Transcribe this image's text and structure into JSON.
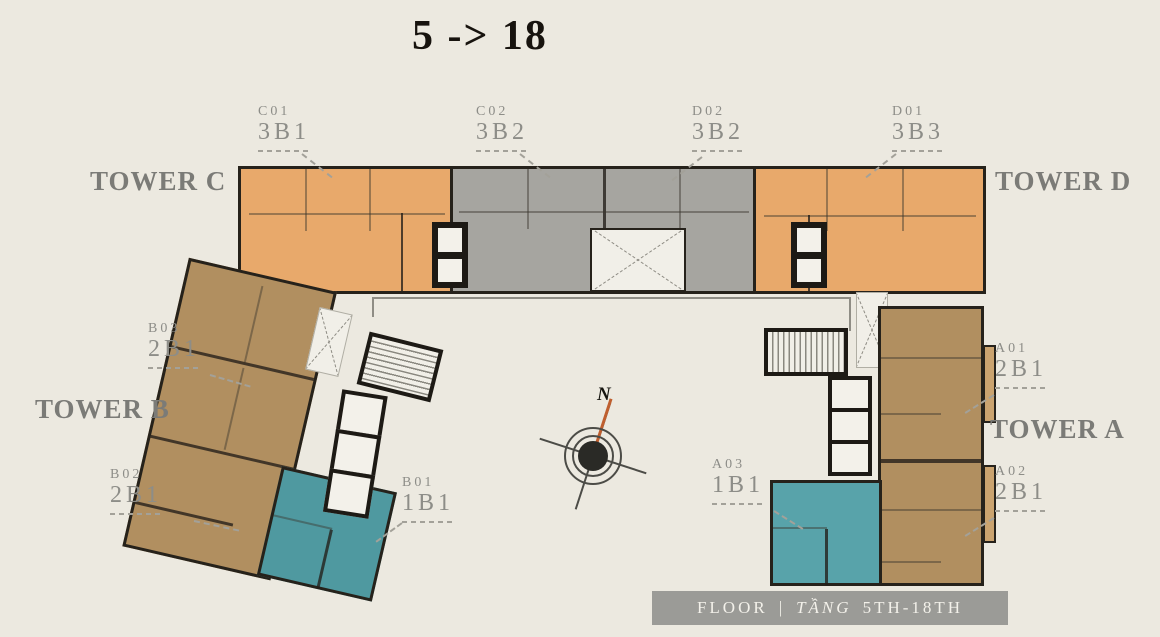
{
  "title": "5 -> 18",
  "towers": [
    {
      "name": "TOWER C"
    },
    {
      "name": "TOWER D"
    },
    {
      "name": "TOWER B"
    },
    {
      "name": "TOWER A"
    }
  ],
  "units": [
    {
      "code": "C01",
      "type": "3B1",
      "color": "#e8a96b"
    },
    {
      "code": "C02",
      "type": "3B2",
      "color": "#a6a5a0"
    },
    {
      "code": "D02",
      "type": "3B2",
      "color": "#a6a5a0"
    },
    {
      "code": "D01",
      "type": "3B3",
      "color": "#e8a96b"
    },
    {
      "code": "B03",
      "type": "2B1",
      "color": "#b18f60"
    },
    {
      "code": "B02",
      "type": "2B1",
      "color": "#b18f60"
    },
    {
      "code": "B01",
      "type": "1B1",
      "color": "#55a0a8"
    },
    {
      "code": "A01",
      "type": "2B1",
      "color": "#b18f60"
    },
    {
      "code": "A03",
      "type": "1B1",
      "color": "#55a0a8"
    },
    {
      "code": "A02",
      "type": "2B1",
      "color": "#b18f60"
    }
  ],
  "compass": {
    "north_label": "N"
  },
  "footer": {
    "floor_label": "FLOOR",
    "separator": "|",
    "tang_label": "TẦNG",
    "range_label": "5TH-18TH"
  },
  "colors": {
    "background": "#ece9e0",
    "orange_unit": "#e8a96b",
    "gray_unit": "#a6a5a0",
    "brown_unit": "#b18f60",
    "teal_unit": "#55a0a8",
    "wall": "#26221b",
    "label_gray": "#8d8d88",
    "tower_label_gray": "#7b7b77",
    "banner_bg": "#9b9b97",
    "banner_text": "#f3f1ea",
    "compass_needle": "#bf5f2f"
  }
}
